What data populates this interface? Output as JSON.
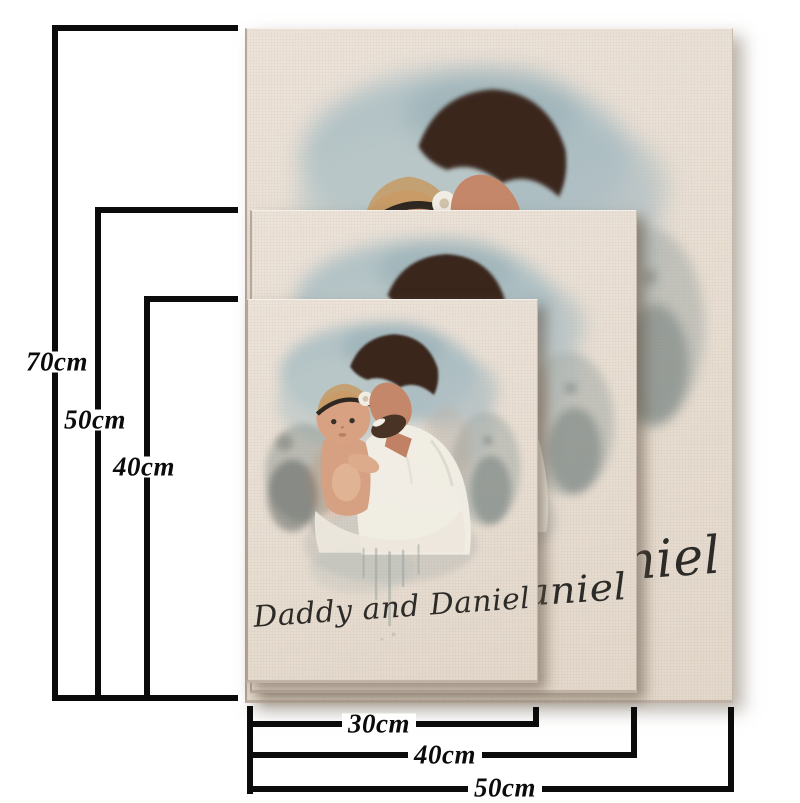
{
  "artwork": {
    "caption": "Daddy and Daniel",
    "caption_color": "#2d2b28"
  },
  "canvases": {
    "face_color": "#e9dfd4",
    "count": 3
  },
  "measurements": {
    "line_color": "#0b0b0b",
    "heights": [
      {
        "label": "70cm"
      },
      {
        "label": "50cm"
      },
      {
        "label": "40cm"
      }
    ],
    "widths": [
      {
        "label": "30cm"
      },
      {
        "label": "40cm"
      },
      {
        "label": "50cm"
      }
    ]
  }
}
